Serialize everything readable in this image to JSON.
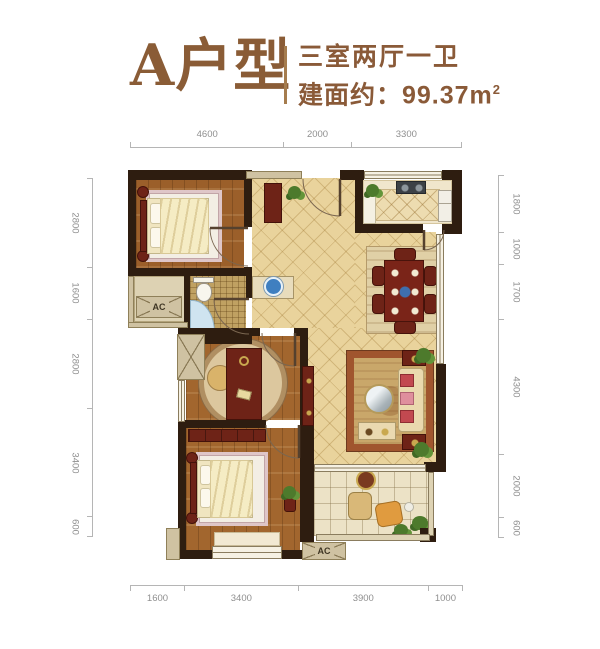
{
  "header": {
    "title": "A户型",
    "subtitle_line1": "三室两厅一卫",
    "area_label": "建面约：99.37m",
    "area_sup": "2"
  },
  "dimensions": {
    "top": [
      "4600",
      "2000",
      "3300"
    ],
    "bottom": [
      "1600",
      "3400",
      "3900",
      "1000"
    ],
    "left": [
      "2800",
      "1600",
      "2800",
      "3400",
      "600"
    ],
    "right": [
      "1800",
      "1000",
      "1700",
      "4300",
      "2000",
      "600"
    ]
  },
  "labels": {
    "ac_left": "AC",
    "ac_bottom": "AC"
  },
  "colors": {
    "accent_brown": "#8a5c36",
    "wall_dark": "#2e1d10",
    "wood_floor": "#a2662e",
    "tile_floor": "#e9d39c",
    "furniture_red": "#6e2317",
    "dimension_text": "#8f8f8f"
  }
}
